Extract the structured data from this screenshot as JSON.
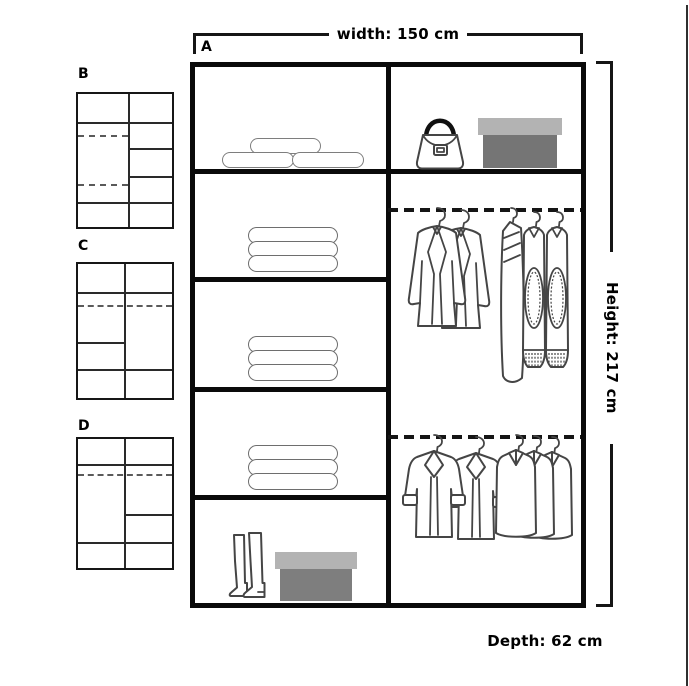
{
  "diagram": {
    "main": {
      "label": "A",
      "dimensions": {
        "width": "width: 150 cm",
        "height": "Height: 217 cm",
        "depth": "Depth: 62 cm"
      },
      "left_column": [
        "pillows",
        "folded clothes",
        "folded clothes",
        "folded clothes",
        "boots and shoe box"
      ],
      "right_column": [
        "handbag and storage box",
        "rail with jackets and sweaters",
        "rail with coats and shirts"
      ]
    },
    "variants": [
      {
        "label": "B"
      },
      {
        "label": "C"
      },
      {
        "label": "D"
      }
    ]
  },
  "icons": {
    "pillow": "rounded-outline-pill",
    "folded_clothes": "stack-of-rounded-rectangles",
    "handbag": "bag-with-black-arc-handle",
    "storage_box": "gray-lidded-box",
    "boots": "pair-of-tall-boots",
    "jackets": "two-blazers-on-hangers",
    "sweaters": "cardigan-and-two-sweaters-on-hangers",
    "coats": "two-coats-with-fur-cuffs-on-hangers",
    "shirts": "three-shirts-on-hangers",
    "hanging_rail": "thick-dashed-line"
  },
  "colors": {
    "outline_black": "#0a0a0a",
    "sketch_gray": "#454545",
    "box_lid_gray": "#b3b3b3",
    "box_body_gray": "#757575"
  }
}
